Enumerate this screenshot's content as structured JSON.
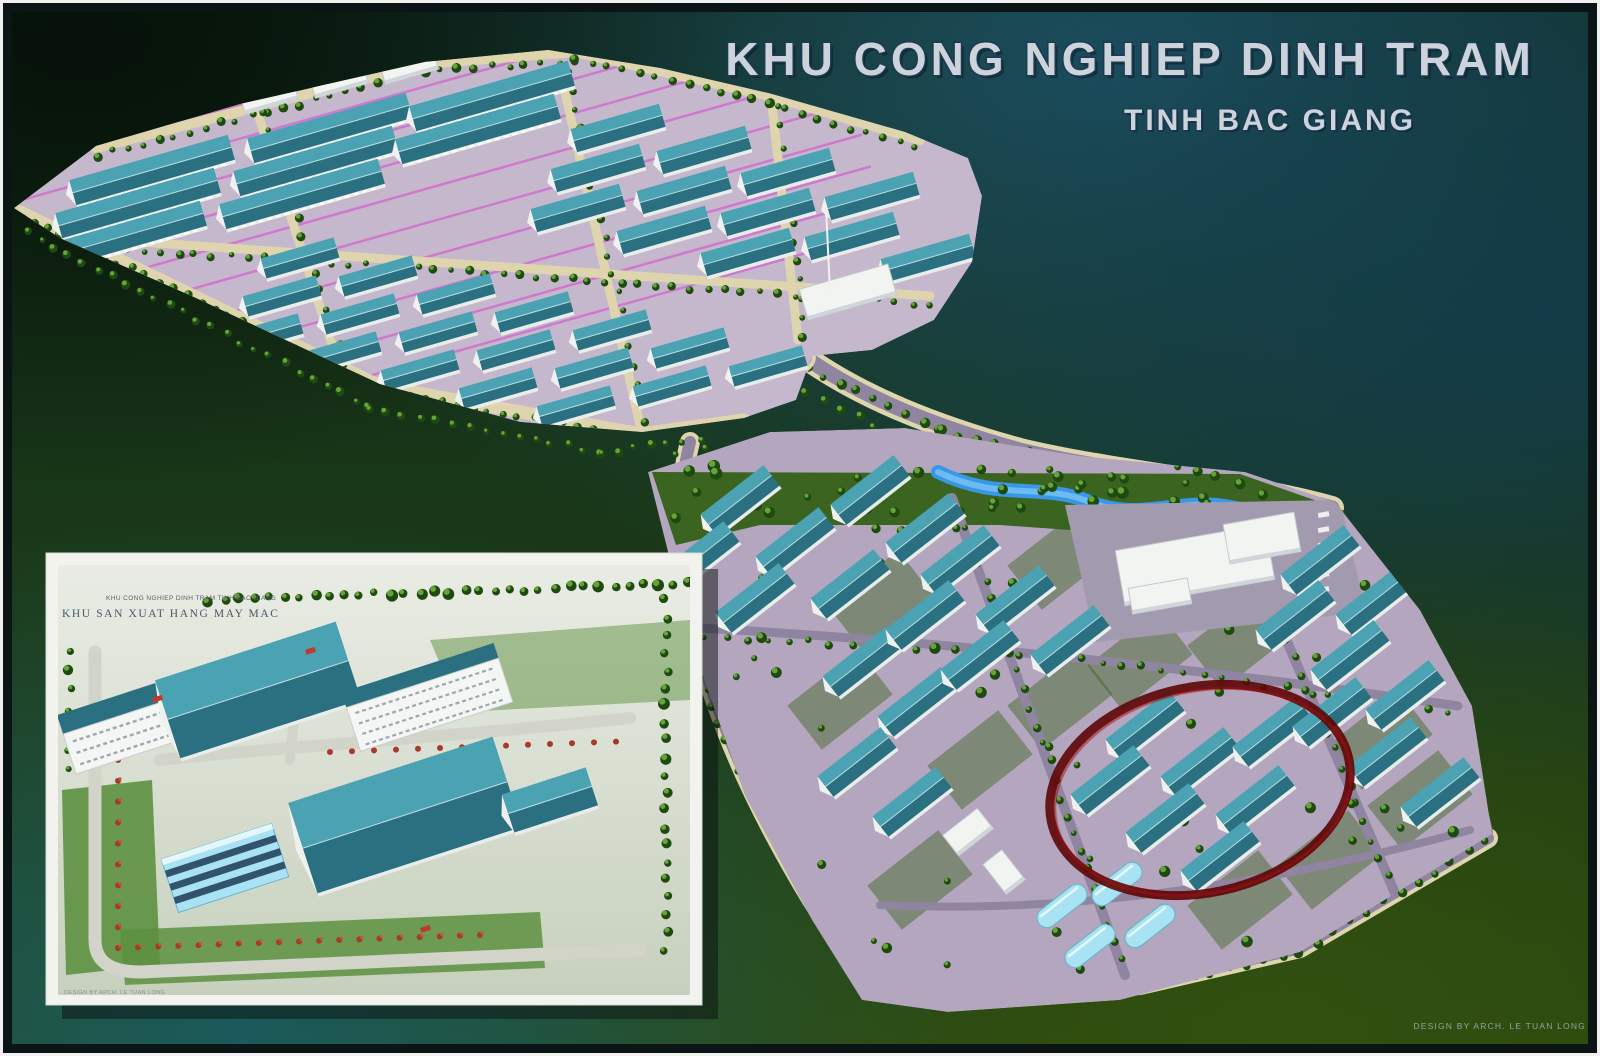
{
  "poster": {
    "title": "KHU CONG NGHIEP DINH TRAM",
    "subtitle": "TINH BAC GIANG"
  },
  "inset": {
    "caption_small": "KHU CONG NGHIEP DINH TRAM TINH BAC GIANG",
    "caption_main": "KHU SAN XUAT HANG MAY MAC",
    "footnote": "DESIGN BY ARCH. LE TUAN LONG"
  },
  "credit": "DESIGN BY ARCH. LE TUAN LONG",
  "colors": {
    "title_fill": "#ccd3da",
    "title_stroke": "#1d3a52",
    "plateau": "#c6b8cc",
    "lower_ground": "#b4a6be",
    "white_lot": "#a29aae",
    "roof_dark": "#2a7080",
    "roof_light": "#4aa2b2",
    "road_cream": "#ded5ae",
    "road_gray": "#8f85a0",
    "tree_dark": "#1e4a12",
    "tree_light": "#6fae3c",
    "green_patch": "#3a6420",
    "river_blue": "#3a97e8",
    "river_light": "#6cbcf2",
    "magenta_line": "#d25fcf",
    "quonset_blue": "#a9e2f2",
    "highlight_red": "#5d0606",
    "highlight_red2": "#a01010",
    "bg_teal_top": "#1d5163",
    "bg_olive": "#2b470e",
    "inset_bg": "#dfe3d8",
    "inset_road": "#d2d4ca",
    "inset_lawn": "#5d9140",
    "flower_red": "#a83a2a"
  }
}
